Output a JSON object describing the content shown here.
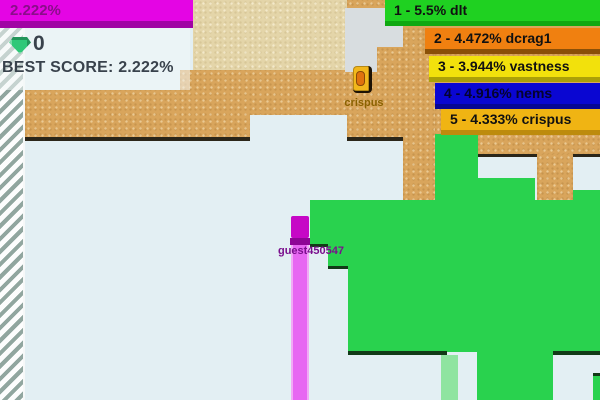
{
  "game_title": "splix.io territory game",
  "score_bar": {
    "percent": "2.222%"
  },
  "stats": {
    "gem_count": "0",
    "best_score_text": "BEST SCORE: 2.222%",
    "best_score_value": "2.222%"
  },
  "leaderboard": {
    "entries": [
      {
        "rank": "1",
        "percent": "5.5%",
        "name": "dlt",
        "label": "1 - 5.5% dlt",
        "color": "#1fd121",
        "border_color": "#0fa811"
      },
      {
        "rank": "2",
        "percent": "4.472%",
        "name": "dcrag1",
        "label": "2 - 4.472% dcrag1",
        "color": "#f08010",
        "border_color": "#8a5008"
      },
      {
        "rank": "3",
        "percent": "3.944%",
        "name": "vastness",
        "label": "3 - 3.944% vastness",
        "color": "#f2e10c",
        "border_color": "#aba008"
      },
      {
        "rank": "4",
        "percent": "4.916%",
        "name": "nems",
        "label": "4 - 4.916% nems",
        "color": "#0a06d2",
        "border_color": "#070694"
      },
      {
        "rank": "5",
        "percent": "4.333%",
        "name": "crispus",
        "label": "5 - 4.333% crispus",
        "color": "#f0b413",
        "border_color": "#bd8b0d"
      }
    ]
  },
  "players": [
    {
      "name": "crispus",
      "block_color": "#f2b71c",
      "label_color": "#8a6200"
    },
    {
      "name": "guest450547",
      "block_color": "#c608c6",
      "trail_color": "#e767f2",
      "label_color": "#7a0f8d"
    }
  ],
  "map_colors": {
    "background": "#e3eff3",
    "wall_stripe": "#91a69f",
    "sand": "#d9a55c",
    "sand_light": "#e4d5a9",
    "green_territory": "#29d24e",
    "green_trail_pale": "#8fe4a0",
    "shadow_line": "#2b2619"
  }
}
